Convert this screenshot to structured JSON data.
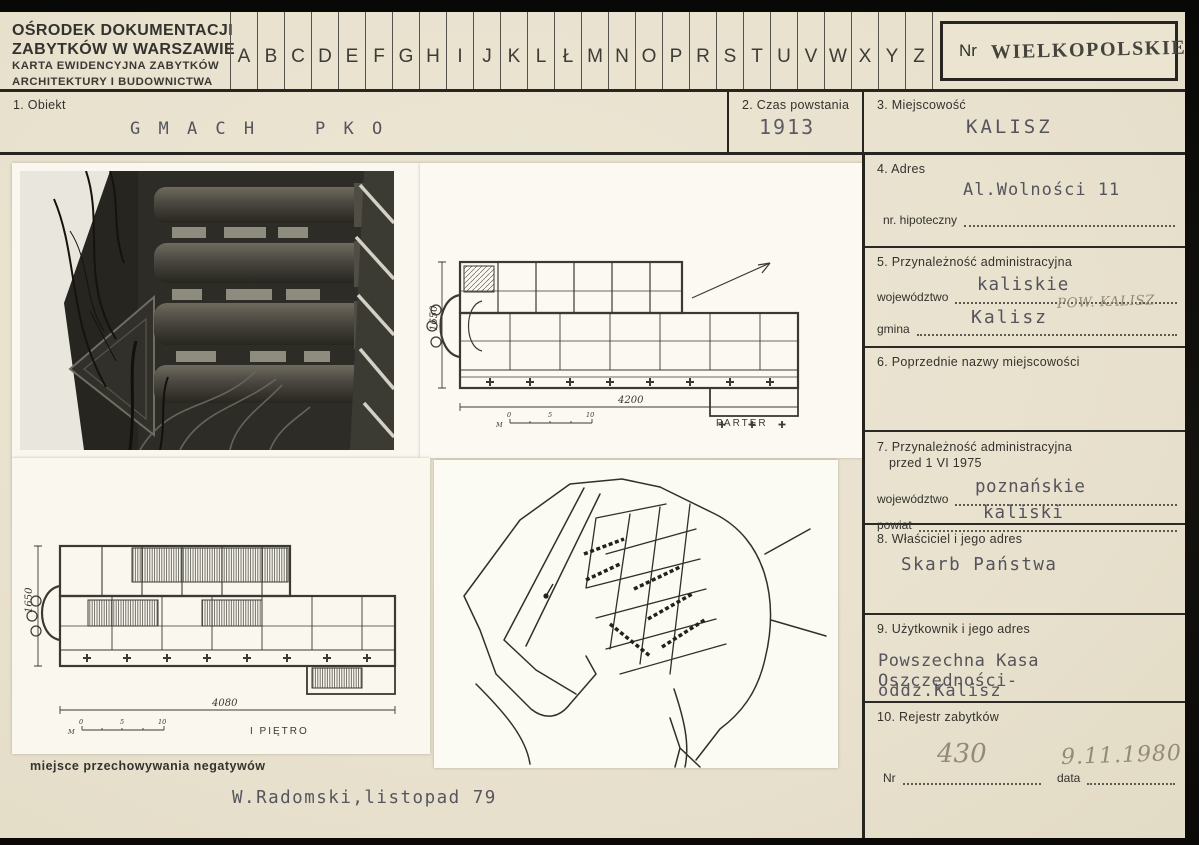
{
  "header": {
    "org_line1": "OŚRODEK DOKUMENTACJI",
    "org_line2": "ZABYTKÓW W WARSZAWIE",
    "org_line3": "KARTA EWIDENCYJNA ZABYTKÓW",
    "org_line4": "ARCHITEKTURY I BUDOWNICTWA",
    "alphabet": [
      "A",
      "B",
      "C",
      "D",
      "E",
      "F",
      "G",
      "H",
      "I",
      "J",
      "K",
      "L",
      "Ł",
      "M",
      "N",
      "O",
      "P",
      "R",
      "S",
      "T",
      "U",
      "V",
      "W",
      "X",
      "Y",
      "Z"
    ],
    "nr_label": "Nr",
    "region_stamp": "WIELKOPOLSKIE"
  },
  "fields": {
    "f1_label": "1. Obiekt",
    "f1_value": "G M A C H    P K O",
    "f2_label": "2. Czas powstania",
    "f2_value": "1913",
    "f3_label": "3. Miejscowość",
    "f3_value": "KALISZ",
    "f4_label": "4. Adres",
    "f4_value": "Al.Wolności 11",
    "f4_sub_label": "nr. hipoteczny",
    "f5_label": "5. Przynależność administracyjna",
    "f5_row1_label": "województwo",
    "f5_row1_value": "kaliskie",
    "f5_pencil_note": "POW. KALISZ",
    "f5_row2_label": "gmina",
    "f5_row2_value": "Kalisz",
    "f6_label": "6. Poprzednie nazwy miejscowości",
    "f7_label_line1": "7. Przynależność administracyjna",
    "f7_label_line2": "przed 1 VI 1975",
    "f7_row1_label": "województwo",
    "f7_row1_value": "poznańskie",
    "f7_row2_label": "powiat",
    "f7_row2_value": "kaliski",
    "f8_label": "8. Właściciel i jego adres",
    "f8_value": "Skarb Państwa",
    "f9_label": "9. Użytkownik i jego adres",
    "f9_value_line1": "Powszechna Kasa Oszczędności-",
    "f9_value_line2": "oddz.Kalisz",
    "f10_label": "10. Rejestr zabytków",
    "f10_nr_label": "Nr",
    "f10_nr_value": "430",
    "f10_data_label": "data",
    "f10_data_value": "9.11.1980"
  },
  "drawings": {
    "plan_parter": {
      "label": "PARTER",
      "width_dim": "4200",
      "height_dim": "1650",
      "scale_unit": "M",
      "tick0": "0",
      "tick5": "5",
      "tick10": "10"
    },
    "plan_pietro": {
      "label": "I PIĘTRO",
      "width_dim": "4080",
      "height_dim": "1650",
      "scale_unit": "M",
      "tick0": "0",
      "tick5": "5",
      "tick10": "10"
    }
  },
  "footer": {
    "negatives_note": "miejsce przechowywania negatywów",
    "author_note": "W.Radomski,listopad 79"
  },
  "colors": {
    "card_bg": "#eae3d0",
    "frame": "#11100c",
    "ink": "#2e2e28",
    "typewriter": "#55545c",
    "pencil": "#948a79",
    "sheet": "#f9f7ee"
  }
}
